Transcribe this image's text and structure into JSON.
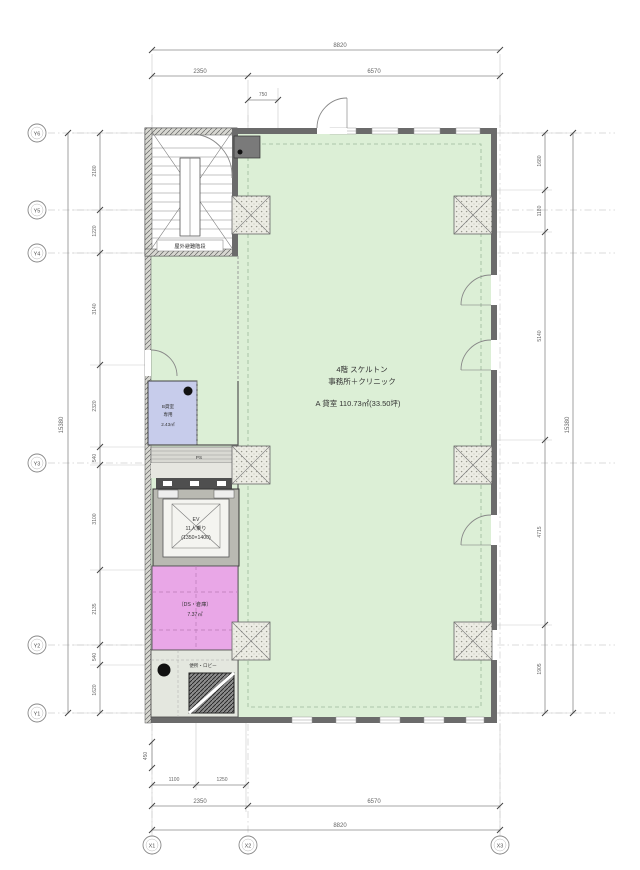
{
  "drawing": {
    "rooms": {
      "main": {
        "line1": "4階 スケルトン",
        "line2": "事務所＋クリニック",
        "area": "A 貸室 110.73㎡(33.50坪)"
      },
      "stair": {
        "label": "屋外避難階段"
      },
      "blue": {
        "line1": "B貸室",
        "line2": "専用",
        "line3": "2.43㎡"
      },
      "elevator": {
        "line1": "EV",
        "line2": "11人乗り",
        "line3": "(1350×1400)"
      },
      "pink": {
        "line1": "（DS・倉庫）",
        "line2": "7.37㎡"
      },
      "toilet": {
        "label": "便所・ロビー"
      },
      "ps": {
        "label": "PS"
      }
    },
    "grid": {
      "y": [
        "Y6",
        "Y5",
        "Y4",
        "Y3",
        "Y2",
        "Y1"
      ],
      "x": [
        "X1",
        "X2",
        "X3"
      ]
    },
    "dims": {
      "top": {
        "overall": "8820",
        "seg_left": "2350",
        "seg_right": "6570",
        "sub": "750"
      },
      "bottom": {
        "small": "450",
        "seg1": "1100",
        "seg2": "1250",
        "row_left": "2350",
        "row_right": "6570",
        "overall": "8820"
      },
      "left": {
        "overall": "15380",
        "segments": [
          "2180",
          "1220",
          "3140",
          "2320",
          "540",
          "3100",
          "2135",
          "540",
          "1620"
        ]
      },
      "right": {
        "overall": "15380",
        "segments": [
          "1680",
          "1180",
          "5140",
          "4715",
          "1905"
        ]
      }
    },
    "colors": {
      "tenant_green": "#dcefd6",
      "wc_blue": "#c7cceb",
      "storage_pink": "#e9a7e7",
      "wall_gray": "#6b6b6b"
    }
  }
}
